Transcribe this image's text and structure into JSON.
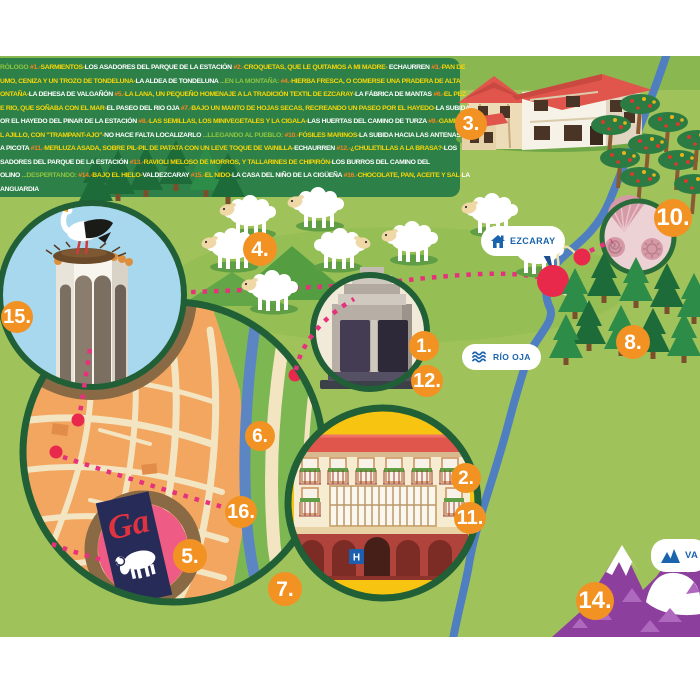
{
  "legend": {
    "lines": [
      [
        {
          "t": "RÓLOGO ",
          "c": "s"
        },
        {
          "t": "#1.-",
          "c": "n"
        },
        {
          "t": "SARMIENTOS-",
          "c": "d"
        },
        {
          "t": "LOS ASADORES DEL PARQUE DE LA ESTACIÓN",
          "c": "p"
        },
        {
          "t": " #2.-",
          "c": "n"
        },
        {
          "t": "CROQUETAS, QUE LE QUITAMOS A MI MADRE- ",
          "c": "d"
        },
        {
          "t": "ECHAURREN",
          "c": "p"
        },
        {
          "t": " #3.-",
          "c": "n"
        },
        {
          "t": "PAN DE",
          "c": "d"
        }
      ],
      [
        {
          "t": "UMO, CENIZA Y UN TROZO DE TONDELUNA-",
          "c": "d"
        },
        {
          "t": "LA ALDEA DE TONDELUNA",
          "c": "p"
        },
        {
          "t": " ...EN LA MONTAÑA: ",
          "c": "s"
        },
        {
          "t": "#4.-",
          "c": "n"
        },
        {
          "t": "HIERBA FRESCA, O COMERSE UNA PRADERA DE ALTA",
          "c": "d"
        }
      ],
      [
        {
          "t": "ONTAÑA-",
          "c": "d"
        },
        {
          "t": "LA DEHESA DE VALGAÑÓN",
          "c": "p"
        },
        {
          "t": " #5.-",
          "c": "n"
        },
        {
          "t": "LA LANA, UN PEQUEÑO HOMENAJE A LA TRADICIÓN TEXTIL DE EZCARAY-",
          "c": "d"
        },
        {
          "t": "LA FÁBRICA DE MANTAS",
          "c": "p"
        },
        {
          "t": " #6.-",
          "c": "n"
        },
        {
          "t": "EL PEZ",
          "c": "d"
        }
      ],
      [
        {
          "t": "E RIO, QUE SOÑABA CON EL MAR-",
          "c": "d"
        },
        {
          "t": "EL PASEO DEL RIO OJA",
          "c": "p"
        },
        {
          "t": " #7.-",
          "c": "n"
        },
        {
          "t": "BAJO UN MANTO DE HOJAS SECAS, RECREANDO UN PASEO POR EL HAYEDO-",
          "c": "d"
        },
        {
          "t": "LA SUBIDA",
          "c": "p"
        }
      ],
      [
        {
          "t": "OR EL HAYEDO DEL PINAR DE LA ESTACIÓN",
          "c": "p"
        },
        {
          "t": " #8.-",
          "c": "n"
        },
        {
          "t": "LAS SEMILLAS, LOS MINIVEGETALES Y LA CIGALA-",
          "c": "d"
        },
        {
          "t": "LAS HUERTAS DEL CAMINO DE TURZA",
          "c": "p"
        },
        {
          "t": " #9.-",
          "c": "n"
        },
        {
          "t": "GAMBAS",
          "c": "d"
        }
      ],
      [
        {
          "t": "L AJILLO, CON \"TRAMPANT-AJO\"-",
          "c": "d"
        },
        {
          "t": "NO HACE FALTA LOCALIZARLO",
          "c": "p"
        },
        {
          "t": " ...LLEGANDO AL PUEBLO: ",
          "c": "s"
        },
        {
          "t": "#10.-",
          "c": "n"
        },
        {
          "t": "FÓSILES MARINOS-",
          "c": "d"
        },
        {
          "t": "LA SUBIDA HACIA LAS ANTENAS DE",
          "c": "p"
        }
      ],
      [
        {
          "t": "A PICOTA",
          "c": "p"
        },
        {
          "t": " #11.-",
          "c": "n"
        },
        {
          "t": "MERLUZA ASADA, SOBRE PIL-PIL DE PATATA CON UN LEVE TOQUE DE VAINILLA-",
          "c": "d"
        },
        {
          "t": "ECHAURREN",
          "c": "p"
        },
        {
          "t": " #12.-",
          "c": "n"
        },
        {
          "t": "¿CHULETILLAS A LA BRASA?-",
          "c": "d"
        },
        {
          "t": "LOS",
          "c": "p"
        }
      ],
      [
        {
          "t": "SADORES DEL PARQUE DE LA ESTACIÓN",
          "c": "p"
        },
        {
          "t": " #13.-",
          "c": "n"
        },
        {
          "t": "RAVIOLI MELOSO DE MORROS, Y TALLARINES DE CHIPIRÓN-",
          "c": "d"
        },
        {
          "t": "LOS BURROS DEL CAMINO DEL",
          "c": "p"
        }
      ],
      [
        {
          "t": "OLINO ",
          "c": "p"
        },
        {
          "t": "...DESPERTANDO: ",
          "c": "s"
        },
        {
          "t": "#14.-",
          "c": "n"
        },
        {
          "t": "BAJO EL HIELO-",
          "c": "d"
        },
        {
          "t": "VALDEZCARAY",
          "c": "p"
        },
        {
          "t": " #15.-",
          "c": "n"
        },
        {
          "t": "EL NIDO-",
          "c": "d"
        },
        {
          "t": "LA CASA DEL NIÑO DE LA CIGÜEÑA",
          "c": "p"
        },
        {
          "t": " #16.-",
          "c": "n"
        },
        {
          "t": "CHOCOLATE, PAN, ACEITE Y SAL-",
          "c": "d"
        },
        {
          "t": "LA",
          "c": "p"
        }
      ],
      [
        {
          "t": "ANGUARDIA",
          "c": "p"
        }
      ]
    ]
  },
  "signs": {
    "ezcaray": {
      "label": "EZCARAY",
      "icon": "house-icon"
    },
    "rio_oja": {
      "label": "RÍO OJA",
      "icon": "waves-icon"
    },
    "summit_partial": {
      "label": "VA",
      "icon": "mountain-icon"
    }
  },
  "hotel": {
    "h_sign": "H"
  },
  "ga_card": {
    "monogram": "Ga"
  },
  "markers": [
    {
      "label": "1.",
      "x": 424,
      "y": 346,
      "r": 15
    },
    {
      "label": "2.",
      "x": 466,
      "y": 478,
      "r": 15
    },
    {
      "label": "3.",
      "x": 471,
      "y": 124,
      "r": 16
    },
    {
      "label": "4.",
      "x": 260,
      "y": 249,
      "r": 17
    },
    {
      "label": "5.",
      "x": 190,
      "y": 556,
      "r": 17
    },
    {
      "label": "6.",
      "x": 260,
      "y": 436,
      "r": 15
    },
    {
      "label": "7.",
      "x": 285,
      "y": 589,
      "r": 17
    },
    {
      "label": "8.",
      "x": 633,
      "y": 342,
      "r": 17
    },
    {
      "label": "10.",
      "x": 673,
      "y": 218,
      "r": 19
    },
    {
      "label": "11.",
      "x": 470,
      "y": 518,
      "r": 16
    },
    {
      "label": "12.",
      "x": 427,
      "y": 381,
      "r": 16
    },
    {
      "label": "14.",
      "x": 595,
      "y": 601,
      "r": 19
    },
    {
      "label": "15.",
      "x": 17,
      "y": 317,
      "r": 16
    },
    {
      "label": "16.",
      "x": 241,
      "y": 512,
      "r": 16
    }
  ],
  "route": {
    "red_dots": [
      [
        78,
        420
      ],
      [
        56,
        452
      ],
      [
        46,
        538
      ],
      [
        295,
        375
      ],
      [
        553,
        281
      ],
      [
        582,
        257
      ]
    ]
  },
  "palette": {
    "accent_orange": "#f29222",
    "route_pink": "#e6317c",
    "river_blue": "#5b85c3",
    "panel_green": "#2e8049",
    "meadow_green": "#a0c25b",
    "marker_red": "#e8294c",
    "mountain_purple": "#8d3f9d",
    "sign_navy": "#1a64ad",
    "dish_yellow": "#f9d606",
    "soft_green": "#8dc63f",
    "circle_border_green": "#215f36"
  }
}
